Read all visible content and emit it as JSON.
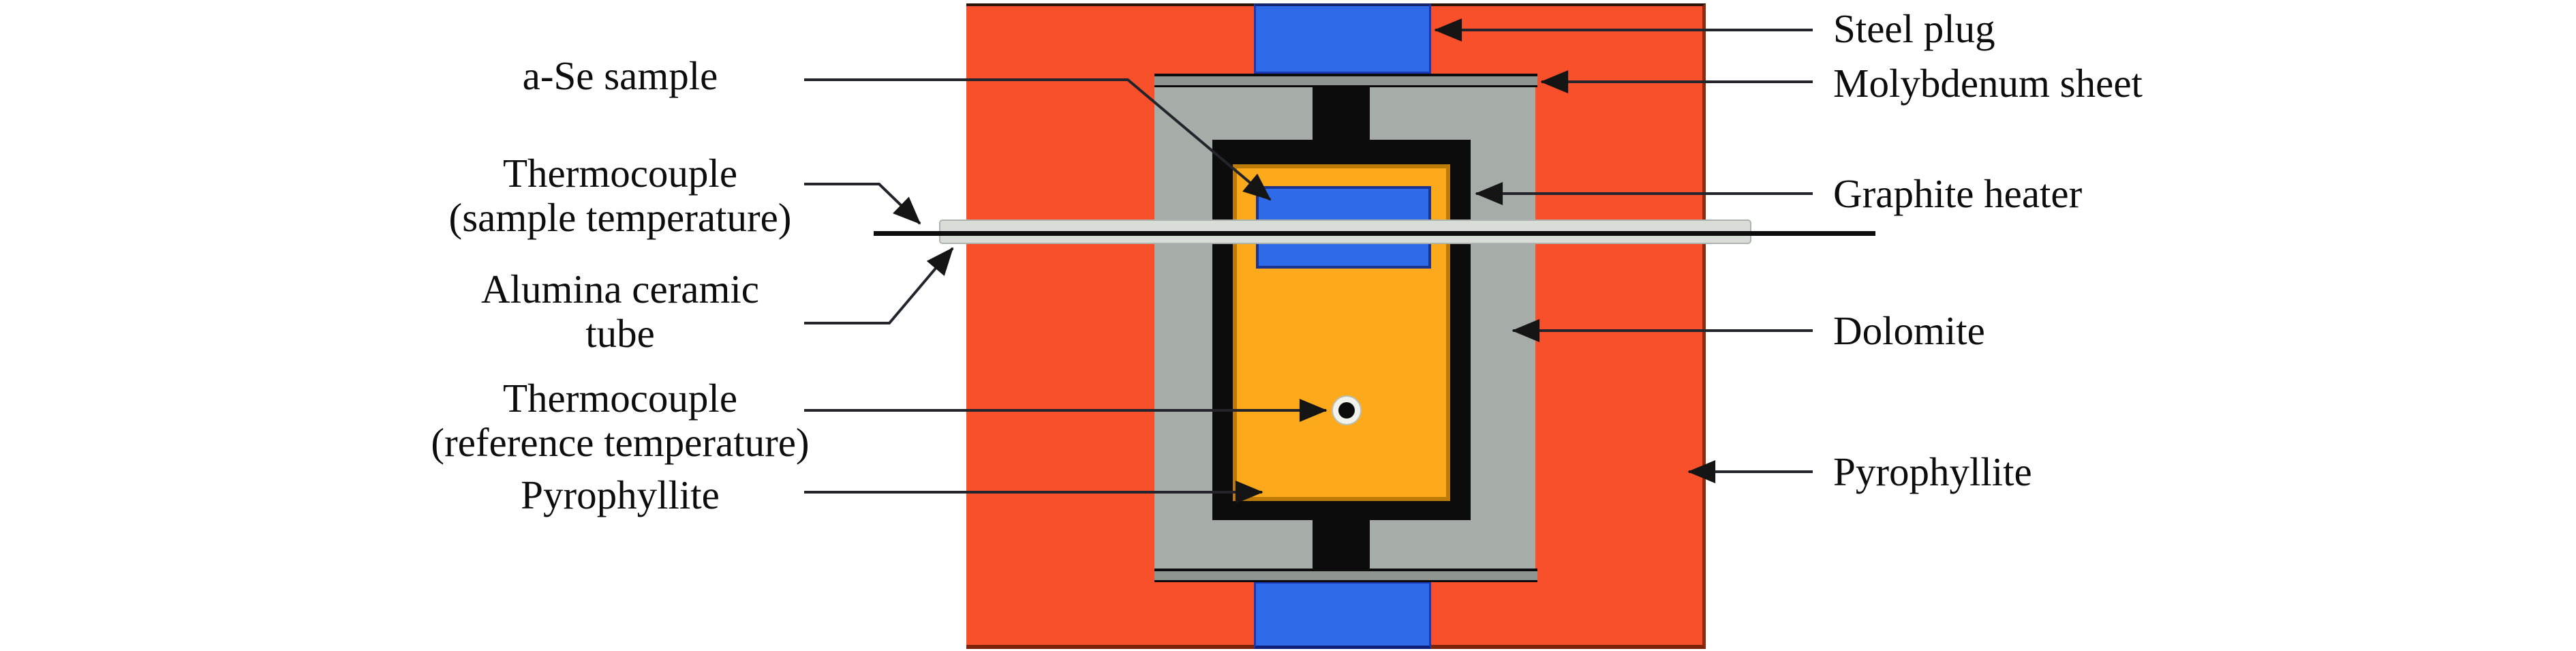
{
  "diagram": {
    "left_labels": {
      "a_se_sample": "a-Se sample",
      "thermocouple_sample_line1": "Thermocouple",
      "thermocouple_sample_line2": "(sample temperature)",
      "alumina_line1": "Alumina ceramic",
      "alumina_line2": "tube",
      "thermocouple_ref_line1": "Thermocouple",
      "thermocouple_ref_line2": "(reference temperature)",
      "pyrophyllite": "Pyrophyllite"
    },
    "right_labels": {
      "steel_plug": "Steel plug",
      "molybdenum_sheet": "Molybdenum sheet",
      "graphite_heater": "Graphite heater",
      "dolomite": "Dolomite",
      "pyrophyllite": "Pyrophyllite"
    },
    "colors": {
      "pyrophyllite_outer": "#F7502A",
      "pyrophyllite_inner": "#FCA91C",
      "steel_plug_blue": "#2F6BE8",
      "a_se_sample_blue": "#2F6BE8",
      "dolomite_gray": "#A6ACA8",
      "molybdenum_gray": "#8F9591",
      "graphite_black": "#0C0C0C",
      "alumina_tube_gray": "#D9DDD7",
      "leader_line": "#24252C",
      "background": "#FFFFFF"
    }
  }
}
